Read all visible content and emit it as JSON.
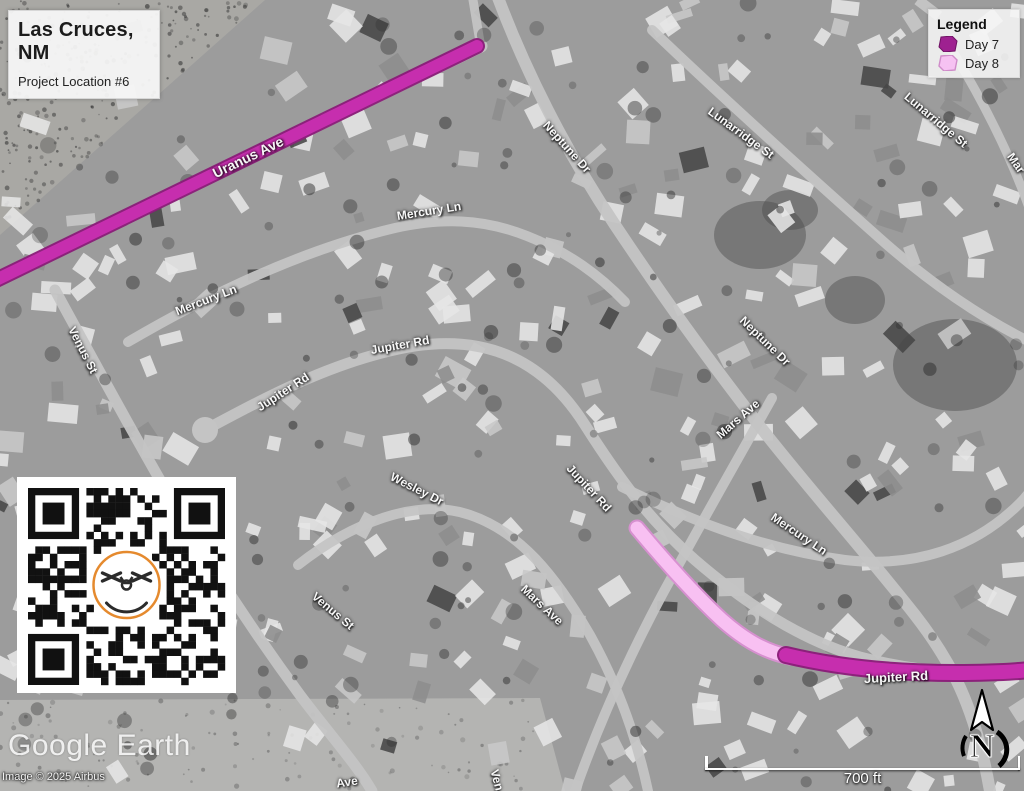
{
  "title_box": {
    "title_line1": "Las Cruces,",
    "title_line2": "NM",
    "subtitle": "Project Location #6"
  },
  "legend": {
    "title": "Legend",
    "items": [
      {
        "label": "Day 7",
        "color": "#9e2190",
        "border": "#6e1263"
      },
      {
        "label": "Day 8",
        "color": "#f6c2f2",
        "border": "#cf8cc9"
      }
    ]
  },
  "colors": {
    "day7_fill": "#c92fb1",
    "day7_casing": "#8a1a78",
    "day8_fill": "#f8c0f2",
    "day8_casing": "#d98fd2"
  },
  "map": {
    "street_labels": [
      {
        "text": "Uranus Ave",
        "x": 248,
        "y": 157,
        "rot": -26,
        "size": 14
      },
      {
        "text": "Mercury Ln",
        "x": 206,
        "y": 300,
        "rot": -21,
        "size": 12
      },
      {
        "text": "Mercury Ln",
        "x": 429,
        "y": 211,
        "rot": -9,
        "size": 12
      },
      {
        "text": "Mercury Ln",
        "x": 799,
        "y": 534,
        "rot": 34,
        "size": 12
      },
      {
        "text": "Venus St",
        "x": 83,
        "y": 350,
        "rot": 63,
        "size": 12
      },
      {
        "text": "Venus St",
        "x": 333,
        "y": 611,
        "rot": 40,
        "size": 12
      },
      {
        "text": "Jupiter Rd",
        "x": 400,
        "y": 345,
        "rot": -10,
        "size": 12
      },
      {
        "text": "Jupiter Rd",
        "x": 283,
        "y": 392,
        "rot": -33,
        "size": 12
      },
      {
        "text": "Jupiter Rd",
        "x": 589,
        "y": 488,
        "rot": 47,
        "size": 12
      },
      {
        "text": "Jupiter Rd",
        "x": 896,
        "y": 677,
        "rot": -3,
        "size": 13
      },
      {
        "text": "Wesley Dr",
        "x": 417,
        "y": 489,
        "rot": 27,
        "size": 12
      },
      {
        "text": "Mars Ave",
        "x": 738,
        "y": 419,
        "rot": -41,
        "size": 12
      },
      {
        "text": "Mars Ave",
        "x": 542,
        "y": 605,
        "rot": 43,
        "size": 12
      },
      {
        "text": "Neptune Dr",
        "x": 567,
        "y": 147,
        "rot": 48,
        "size": 12
      },
      {
        "text": "Neptune Dr",
        "x": 765,
        "y": 341,
        "rot": 44,
        "size": 12
      },
      {
        "text": "Lunarridge St",
        "x": 741,
        "y": 133,
        "rot": 36,
        "size": 12
      },
      {
        "text": "Lunarridge St",
        "x": 936,
        "y": 120,
        "rot": 40,
        "size": 12
      },
      {
        "text": "Mar",
        "x": 1016,
        "y": 163,
        "rot": 55,
        "size": 12
      },
      {
        "text": "Ave",
        "x": 347,
        "y": 782,
        "rot": -8,
        "size": 12
      },
      {
        "text": "Ven",
        "x": 497,
        "y": 780,
        "rot": 75,
        "size": 12
      }
    ]
  },
  "watermark": "Google Earth",
  "copyright": "Image © 2025 Airbus",
  "scale_bar": {
    "label": "700 ft"
  },
  "north": {
    "label": "N"
  }
}
